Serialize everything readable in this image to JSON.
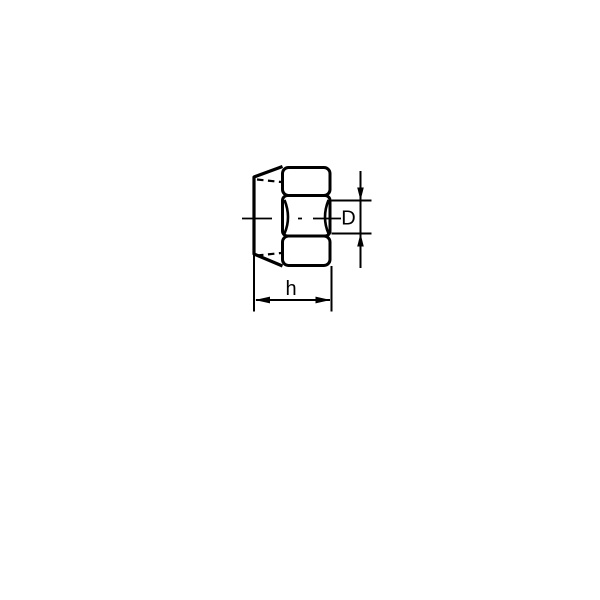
{
  "figure": {
    "background_color": "#ffffff",
    "stroke_color": "#000000",
    "labels": {
      "diameter": "D",
      "height": "h"
    }
  }
}
